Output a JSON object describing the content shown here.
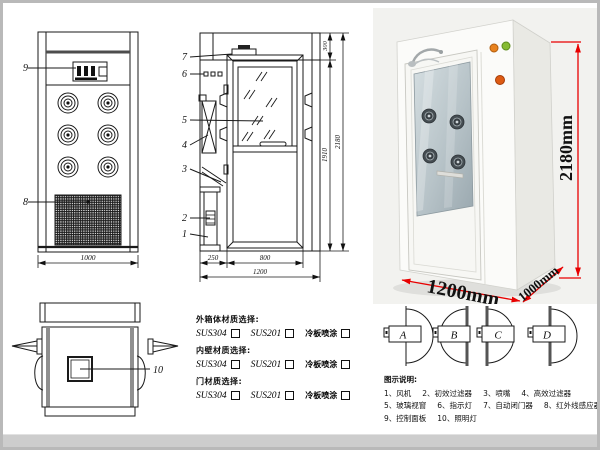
{
  "front_view": {
    "label_9": "9",
    "label_8": "8",
    "dim_width": "1000"
  },
  "side_view": {
    "label_7": "7",
    "label_6": "6",
    "label_5": "5",
    "label_4": "4",
    "label_3": "3",
    "label_2": "2",
    "label_1": "1",
    "dim_top": "300",
    "dim_door_height": "1910",
    "dim_total_height": "2180",
    "dim_left": "250",
    "dim_door_width": "800",
    "dim_total_width": "1200"
  },
  "top_view": {
    "label_10": "10"
  },
  "photo": {
    "dim_height": "2180mm",
    "dim_width": "1200mm",
    "dim_depth": "1000mm",
    "accent_color": "#e80000"
  },
  "materials": {
    "groups": [
      {
        "title": "外箱体材质选择:",
        "options": [
          "SUS304",
          "SUS201",
          "冷板喷涂"
        ]
      },
      {
        "title": "内壁材质选择:",
        "options": [
          "SUS304",
          "SUS201",
          "冷板喷涂"
        ]
      },
      {
        "title": "门材质选择:",
        "options": [
          "SUS304",
          "SUS201",
          "冷板喷涂"
        ]
      }
    ]
  },
  "door_options": {
    "a": "A",
    "b": "B",
    "c": "C",
    "d": "D"
  },
  "legend": {
    "title": "图示说明:",
    "row1": [
      "1、风机",
      "2、初效过滤器",
      "3、喷嘴",
      "4、高效过滤器"
    ],
    "row2": [
      "5、玻璃视窗",
      "6、指示灯",
      "7、自动闭门器",
      "8、红外线感应器"
    ],
    "row3": [
      "9、控制面板",
      "10、照明灯"
    ]
  }
}
